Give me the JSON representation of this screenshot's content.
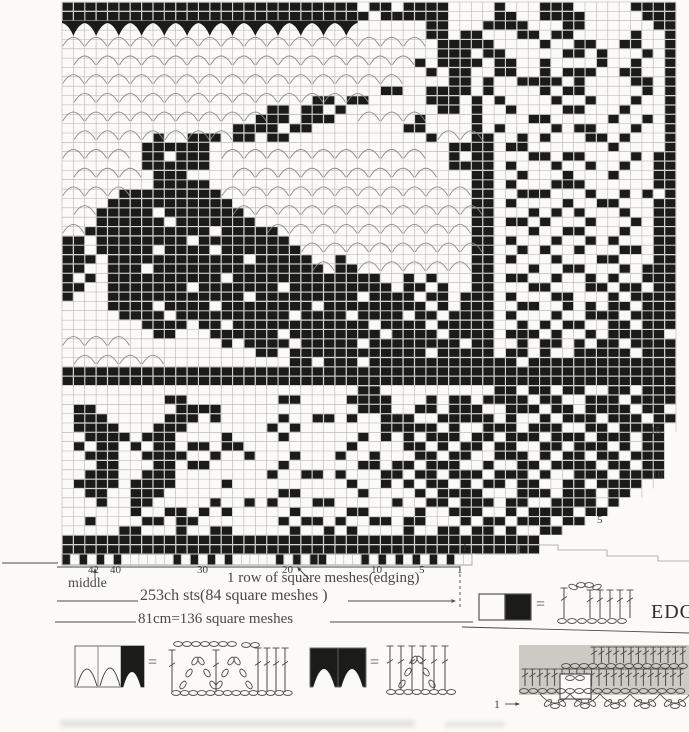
{
  "chart": {
    "colors": {
      "paper": "#fbfaf6",
      "ink": "#1b1b19",
      "grid": "#b3b1aa",
      "arc": "#8d8d87",
      "annotation": "#4a4945",
      "shade": "#cbcbc4"
    },
    "grid_rows": [
      [
        "######",
        "######",
        "######",
        "######",
        "##.##.",
        "####..",
        "..#...",
        "###...",
        "..####"
      ],
      [
        "######",
        "######",
        "######",
        "######",
        "###.##",
        "####..",
        "..##..",
        "####..",
        "...###"
      ],
      [
        "v.v.v.",
        "v.v.v.",
        "v.v.v.",
        "v.v.v.",
        "v.....",
        "..##..",
        ".####.",
        "..##..",
        "....##"
      ],
      [
        "n.n.n.",
        "n.n.n.",
        "n.n.n.",
        "n.n.n.",
        "n.n.n.",
        "n.##.#",
        "#...##",
        ".##...",
        "..#..#"
      ],
      [
        "......",
        "......",
        "......",
        "......",
        "......",
        "...###",
        "##....",
        "#..##.",
        ".##..#"
      ],
      [
        ".n.n.n",
        ".n.n.n",
        ".n.n.n",
        ".n.n.n",
        ".n.n.n",
        "...###",
        ".##...",
        "..##.#",
        "...#.#"
      ],
      [
        "......",
        "......",
        "......",
        "......",
        "......",
        ".#.###",
        "#.##..",
        "#....#",
        "..#..#"
      ],
      [
        "n.n.n.",
        "n.n.n.",
        "n.n.n.",
        "n.n.n.",
        "n.n.n.",
        "..#.##",
        "..##..",
        "#.###.",
        ".##..#"
      ],
      [
        "......",
        "......",
        "......",
        "......",
        "......",
        "....##",
        ".#..##",
        "##.#..",
        "..##.#"
      ],
      [
        ".n.n.n",
        ".n.n.n",
        ".n.n.n",
        ".n.n.n",
        ".n..##",
        "..####",
        ".#....",
        "#.##..",
        "...#.#"
      ],
      [
        "......",
        "......",
        "......",
        "....##",
        ".##...",
        "..###.",
        "#.#...",
        ".#..#.",
        "..#..#"
      ],
      [
        "n.n.n.",
        "n.n.n.",
        "n.n.n.",
        "##.##.",
        "#.n.n.",
        "n..##.",
        "#..#..",
        "..##..",
        ".#...#"
      ],
      [
        "......",
        "......",
        ".....#",
        "##.###",
        "......",
        ".#....",
        "#....#",
        "#.....",
        "#..#.#"
      ],
      [
        ".n.n.n",
        ".n.n.n",
        ".n.###",
        "#.##..",
        "......",
        "##.n.n",
        "#.#...",
        ".#.##.",
        "..#..#"
      ],
      [
        "......",
        "..#..#",
        "##.##.",
        "##....",
        "......",
        "..#...",
        "##..#.",
        "#...##",
        ".#...#"
      ],
      [
        "n.n.n.",
        ".#####",
        "#.n.n.",
        "n.n.n.",
        "n.n.n.",
        "n...##",
        "##.##.",
        "......",
        "#....#"
      ],
      [
        "......",
        ".##.##",
        "#.....",
        "......",
        "......",
        "....#.",
        "##...#",
        "#.##..",
        "..#.##"
      ],
      [
        ".n.n.n",
        ".#####",
        "#..n.n",
        ".n.n.n",
        ".n.n.n",
        ".n..##",
        "##.#..",
        ".#..#.",
        ".#..##"
      ],
      [
        "......",
        "..###.",
        "......",
        "......",
        "......",
        "......",
        "##..#.",
        "..#...",
        "#...##"
      ],
      [
        "n.n.n.",
        "..####",
        "#.n.n.",
        "n.n.n.",
        "n.n.n.",
        "n.n.n.",
        "##.#..",
        ".###..",
        "....##"
      ],
      [
        ".....#",
        "######",
        "##....",
        "......",
        "......",
        "......",
        "##..##",
        "#...#.",
        ".#.#.#"
      ],
      [
        ".n..##",
        "######",
        "###n.n",
        ".n.n.n",
        ".n.n.n",
        ".n.n.n",
        "##.#..",
        "..#..#",
        "#...##"
      ],
      [
        "...###",
        "##.###",
        "####..",
        "......",
        "......",
        "......",
        "##...#",
        ".#.#..",
        ".#..##"
      ],
      [
        "n..###",
        "###.##",
        "#####.",
        "n.n.n.",
        "n.n.n.",
        "n.n.n.",
        "##.##.",
        "#...#.",
        "..#.##"
      ],
      [
        "..####",
        "######",
        "#.####",
        "#.....",
        "......",
        "......",
        "##...#",
        "..##..",
        ".#..##"
      ],
      [
        "##.###",
        "#####.",
        "######",
        "##.n.n",
        ".n.n.n",
        ".n.n.n",
        "##.#..",
        ".#..#.",
        "#...##"
      ],
      [
        "##.###",
        "##.###",
        "#.####",
        "###...",
        "......",
        "......",
        "##..#.",
        "#..#..",
        ".##.##"
      ],
      [
        "###.##",
        "######",
        "####.#",
        "####n.",
        "#.n.n.",
        "n.n.n.",
        "##.#..",
        ".#...#",
        "#...##"
      ],
      [
        "##..##",
        "#.####",
        "######",
        "#####.",
        "##....",
        "......",
        "##...#",
        "..##..",
        ".#.###"
      ],
      [
        "#.#.##",
        "######",
        "##.###",
        "######",
        "####..",
        "#.#...",
        "##.##.",
        ".#..#.",
        "#..###"
      ],
      [
        "##..##",
        "#####.",
        "######",
        "#.####",
        "#####.",
        "##.#..",
        "##...#",
        "#...##",
        ".##.##"
      ],
      [
        "#...##",
        "######",
        "####.#",
        "######",
        "##.###",
        "#.##.#",
        "##.#..",
        ".##...",
        "#.####"
      ],
      [
        "....##",
        "##.###",
        "#.####",
        "####.#",
        "######",
        "##.#.#",
        "##..##",
        "..#.#.",
        "##.###"
      ],
      [
        ".....#",
        "###.##",
        "######",
        "##.###",
        "#.####",
        ".##.##",
        "##.#..",
        ".#..##",
        "#.####"
      ],
      [
        "......",
        ".####.",
        "##.###",
        "######",
        "###.##",
        "##.###",
        "##..#.",
        "#.##..",
        "##.###"
      ],
      [
        "n.n.n.",
        "..##..",
        ".#####",
        "#.####",
        "####.#",
        "###.##",
        "##.###",
        ".#..#.",
        "#####."
      ],
      [
        "......",
        "......",
        "..#.##",
        "##.###",
        "##.###",
        "#####.",
        "##..#.",
        "##.#.#",
        "#.####"
      ],
      [
        ".n.n.n",
        ".n....",
        ".....#",
        "#.####",
        "######",
        "##.###",
        "##.##.",
        "#..###",
        "##.###"
      ],
      [
        "......",
        "......",
        "......",
        "..##.#",
        "##.###",
        "######",
        "####.#",
        "######",
        "######"
      ],
      [
        "######",
        "######",
        "######",
        "######",
        "######",
        "######",
        "######",
        "######",
        "######"
      ],
      [
        "######",
        "######",
        "######",
        "######",
        "######",
        "######",
        "######",
        "######",
        "######"
      ],
      [
        "......",
        "......",
        "......",
        "......",
        "..##..",
        "......",
        "..##.#",
        "#.##..",
        "##.###"
      ],
      [
        "......",
        "...##.",
        "......",
        ".##...",
        ".####.",
        "..#.##",
        ".####.",
        "##..##",
        "#.####"
      ],
      [
        ".##...",
        "....##",
        "##....",
        "......",
        "..###.",
        ".##.##",
        "#..###",
        ".##.##",
        "##.##."
      ],
      [
        ".###..",
        "...###",
        ".#....",
        ".#..##",
        ".#..##",
        "#..###",
        "##.#..",
        "#.###.",
        "###.##"
      ],
      [
        ".####.",
        "..###.",
        "......",
        "#.#...",
        "....##",
        "###.#.",
        ".###.#",
        "##..##",
        ".####."
      ],
      [
        "..####",
        ".###..",
        "..#...",
        ".#....",
        "..#.#.",
        "#.###.",
        "##.###",
        ".###.#",
        "##.## "
      ],
      [
        ".#.##.",
        "#.##.#",
        "#.##..",
        "......",
        ".#....",
        "##.#.#",
        "#.##..",
        "##.###",
        ".#.## "
      ],
      [
        "..###.",
        ".####.",
        ".#..#.",
        "..#...",
        "#..#..",
        ".##.##",
        "..###.",
        "#.##.#",
        "#.### "
      ],
      [
        "...##.",
        "..##.#",
        "#.....",
        ".#....",
        "..##.#",
        "#.###.",
        ".#..##",
        ".####.",
        "##.## "
      ],
      [
        "..###.",
        ".###..",
        "......",
        "#..##.",
        "#...##",
        ".##.##",
        "#.###.",
        "#..###",
        ".#### "
      ],
      [
        ".####.",
        "####..",
        "..#...",
        "......",
        ".#..#.",
        "#.##.#",
        ".##.##",
        "..##.#",
        "###.  "
      ],
      [
        "..##..",
        "###...",
        "......",
        ".##...",
        "..#...",
        ".#.###",
        "#...##",
        "#.###.",
        "##.   "
      ],
      [
        "...#..",
        "##....",
        ".#..#.",
        "#...##",
        ".....#",
        "..##.#",
        "##.##.",
        ".####.",
        "#     "
      ],
      [
        "......",
        "#..##.",
        "#.#...",
        "..#...",
        ".##...",
        ".#..##",
        "#..#.#",
        "###.##",
        "      "
      ],
      [
        "..#...",
        ".##.##",
        "......",
        ".#.##.",
        "#..##.",
        "##...#",
        ".##.##",
        "#.##  ",
        "      "
      ],
      [
        ".....#",
        "#...#.",
        ".##...",
        "..#..#",
        ".#....",
        "#..##.",
        "##.#..",
        "##    ",
        "      "
      ],
      [
        "######",
        "######",
        "######",
        "######",
        "######",
        "######",
        "######",
        "      ",
        "      "
      ],
      [
        "######",
        "######",
        "######",
        "######",
        "######",
        "######",
        "######",
        "      ",
        "      "
      ]
    ],
    "edging_row": [
      "#.#.#.",
      "#.....",
      ".#.#.#",
      ".#....",
      ".#.#.#",
      "#....#",
      ".#.#.#",
      ".#.#.."
    ]
  },
  "bottom_axis": {
    "numbers": [
      {
        "label": "42",
        "x": 88
      },
      {
        "label": "40",
        "x": 110
      },
      {
        "label": "30",
        "x": 197
      },
      {
        "label": "20",
        "x": 282
      },
      {
        "label": "10",
        "x": 371
      },
      {
        "label": "5",
        "x": 419
      },
      {
        "label": "1",
        "x": 457
      }
    ]
  },
  "right_axis": {
    "numbers": [
      {
        "label": "15",
        "x": 650,
        "y": 426
      },
      {
        "label": "10",
        "x": 652,
        "y": 470
      },
      {
        "label": "5",
        "x": 597,
        "y": 515
      },
      {
        "label": "1",
        "x": 462,
        "y": 543
      }
    ]
  },
  "annotations": {
    "middle_label": "middle",
    "edging_row_label": "1 row of square meshes(edging)",
    "chain_count_label": "253ch sts(84 square meshes )",
    "width_label": "81cm=136 square meshes",
    "edging_section_label": "EDG",
    "edging_row_number": "1"
  },
  "legend": {
    "equals": "="
  }
}
